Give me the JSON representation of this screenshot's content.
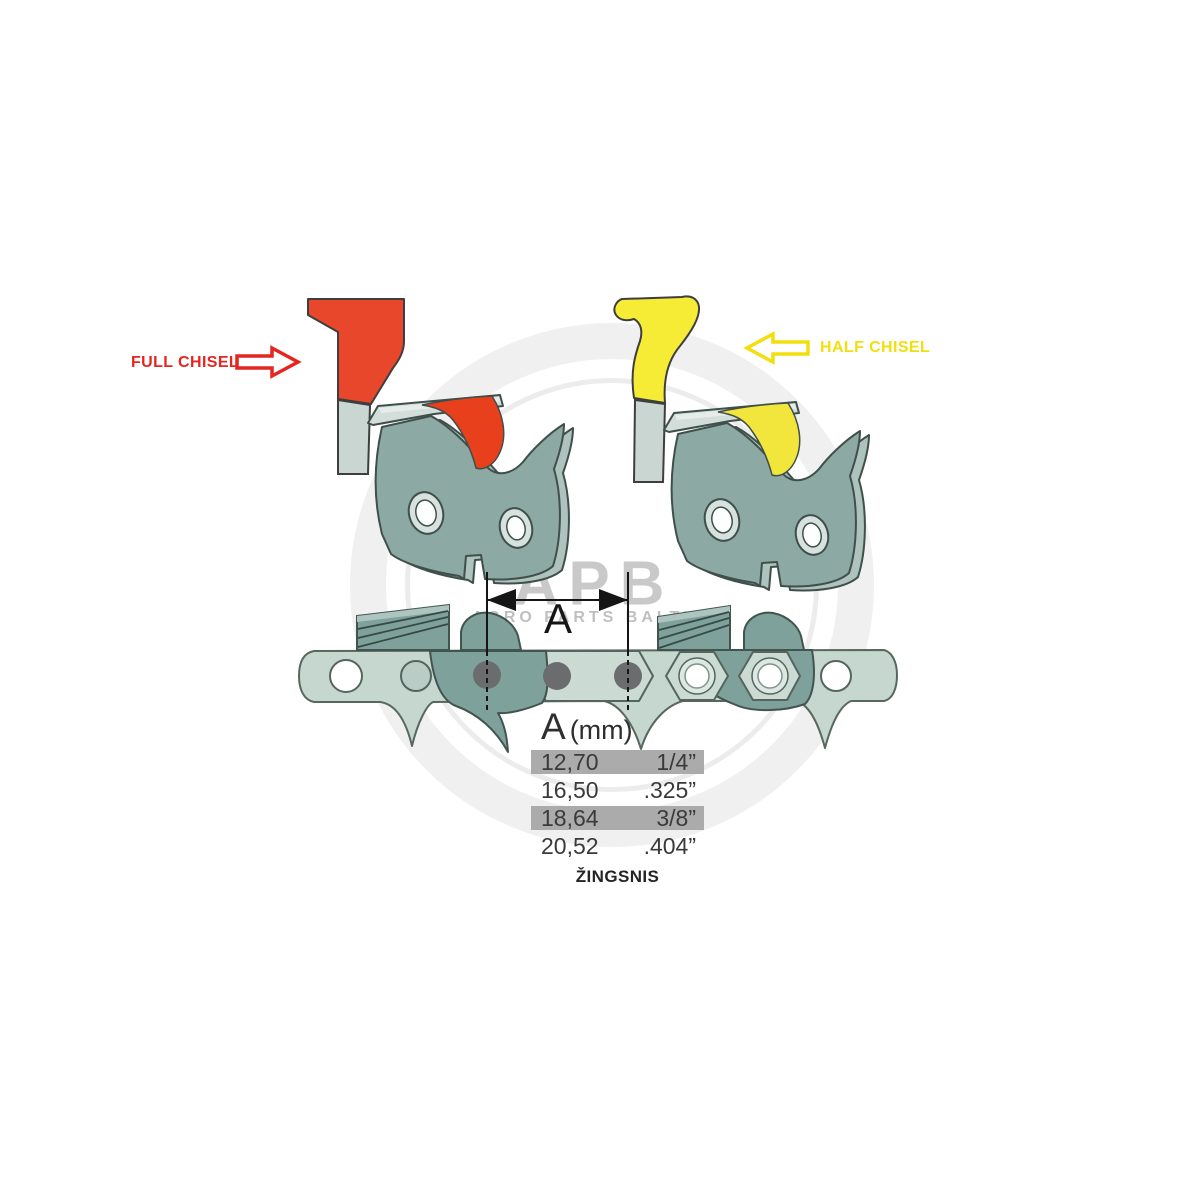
{
  "labels": {
    "full_chisel": "FULL CHISEL",
    "half_chisel": "HALF CHISEL",
    "dimension": "A",
    "pitch_caption": "ŽINGSNIS"
  },
  "table": {
    "header": {
      "symbol": "A",
      "unit": "(mm)"
    },
    "rows": [
      {
        "mm": "12,70",
        "inch": "1/4”"
      },
      {
        "mm": "16,50",
        "inch": ".325”"
      },
      {
        "mm": "18,64",
        "inch": "3/8”"
      },
      {
        "mm": "20,52",
        "inch": ".404”"
      }
    ]
  },
  "watermark": {
    "initials": "APB",
    "name": "AGRO PARTS BALTIJA"
  },
  "colors": {
    "full_chisel_red": "#E8472B",
    "full_chisel_band_red": "#E8401C",
    "full_chisel_text_red": "#E52520",
    "half_chisel_yellow": "#F7EC35",
    "half_chisel_band_yellow": "#F2E53B",
    "half_chisel_text_yellow": "#F3DE0E",
    "link_steel_teal": "#8CA9A4",
    "chain_sage": "#C6D7CF",
    "chain_cutter_teal": "#7FA19B",
    "table_row_gray": "#ABABAB"
  }
}
